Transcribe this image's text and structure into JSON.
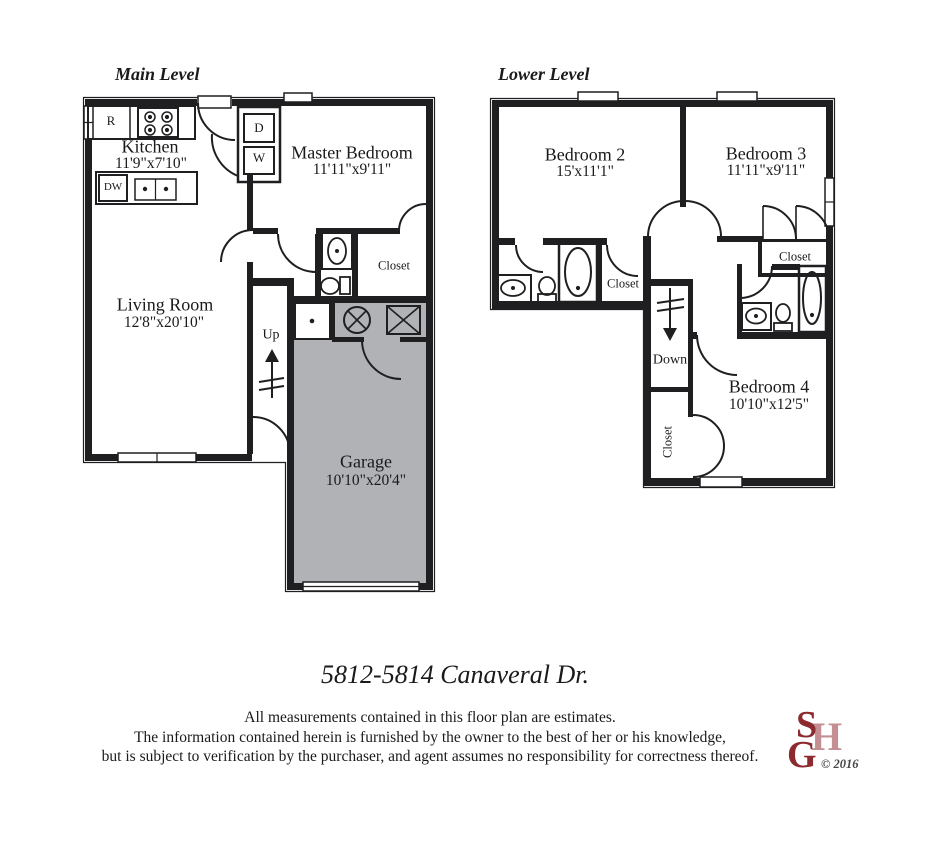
{
  "main_level": {
    "title": "Main Level",
    "rooms": {
      "kitchen": {
        "name": "Kitchen",
        "dims": "11'9\"x7'10\""
      },
      "master_bedroom": {
        "name": "Master Bedroom",
        "dims": "11'11\"x9'11\""
      },
      "living_room": {
        "name": "Living Room",
        "dims": "12'8\"x20'10\""
      },
      "garage": {
        "name": "Garage",
        "dims": "10'10\"x20'4\""
      },
      "closet": "Closet",
      "stairs_label": "Up"
    },
    "appliances": {
      "refrigerator": "R",
      "dishwasher": "DW",
      "dryer": "D",
      "washer": "W"
    }
  },
  "lower_level": {
    "title": "Lower Level",
    "rooms": {
      "bedroom2": {
        "name": "Bedroom 2",
        "dims": "15'x11'1\""
      },
      "bedroom3": {
        "name": "Bedroom 3",
        "dims": "11'11\"x9'11\""
      },
      "bedroom4": {
        "name": "Bedroom 4",
        "dims": "10'10\"x12'5\""
      },
      "closet_bath": "Closet",
      "closet_bedroom3": "Closet",
      "closet_stairs": "Closet",
      "stairs_label": "Down"
    }
  },
  "footer": {
    "address": "5812-5814 Canaveral Dr.",
    "disclaimer": {
      "line1": "All measurements contained in this floor plan are estimates.",
      "line2": "The information contained herein is furnished by the owner to the best of her or his knowledge,",
      "line3": "but is subject to verification by the purchaser, and agent assumes no responsibility for correctness thereof."
    },
    "logo": {
      "s": "S",
      "h": "H",
      "g": "G",
      "copyright": "© 2016"
    }
  },
  "colors": {
    "wall": "#1f1f21",
    "garage_fill": "#b1b2b6",
    "logo_dark": "#8d2a2e",
    "logo_light": "#c38f92",
    "copyright_gray": "#474747"
  }
}
